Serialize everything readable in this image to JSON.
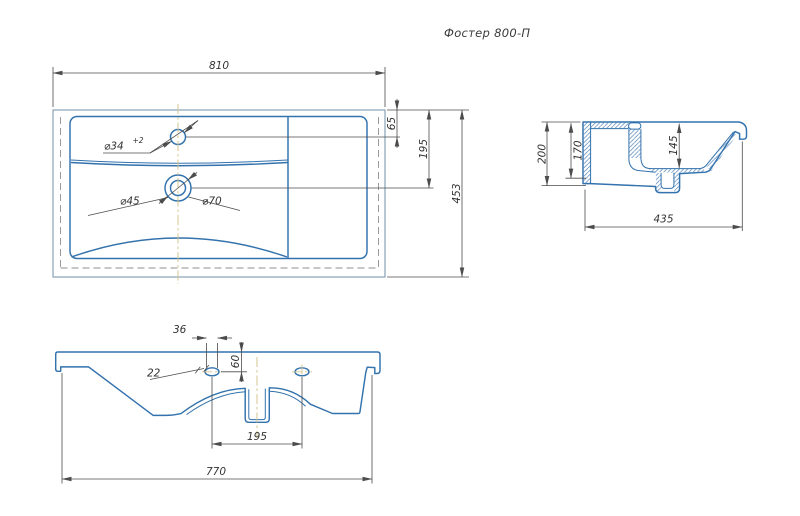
{
  "title": "Фостер 800-П",
  "colors": {
    "outline_blue": "#3272ad",
    "outer_edge_gray_blue": "#7e99b0",
    "hidden_line_gray": "#8f8f8f",
    "dimension_gray": "#4c4c4c",
    "centerline_olive": "#d3c28e",
    "background": "#ffffff"
  },
  "plan_view": {
    "dims": {
      "overall_width": "810",
      "faucet_offset_from_back": "65",
      "drain_offset_from_back": "195",
      "overall_depth": "453"
    },
    "callouts": {
      "faucet_hole_dia": "⌀34",
      "faucet_hole_tolerance": "+2",
      "drain_inner_dia": "⌀45",
      "drain_outer_dia": "⌀70"
    }
  },
  "side_view": {
    "dims": {
      "overall_height": "200",
      "back_wall_height": "170",
      "bowl_depth": "145",
      "overall_depth": "435"
    }
  },
  "front_view": {
    "dims": {
      "slot_offset": "36",
      "slot_length": "22",
      "hole_drop": "60",
      "hole_spacing": "195",
      "mounting_width": "770"
    }
  }
}
